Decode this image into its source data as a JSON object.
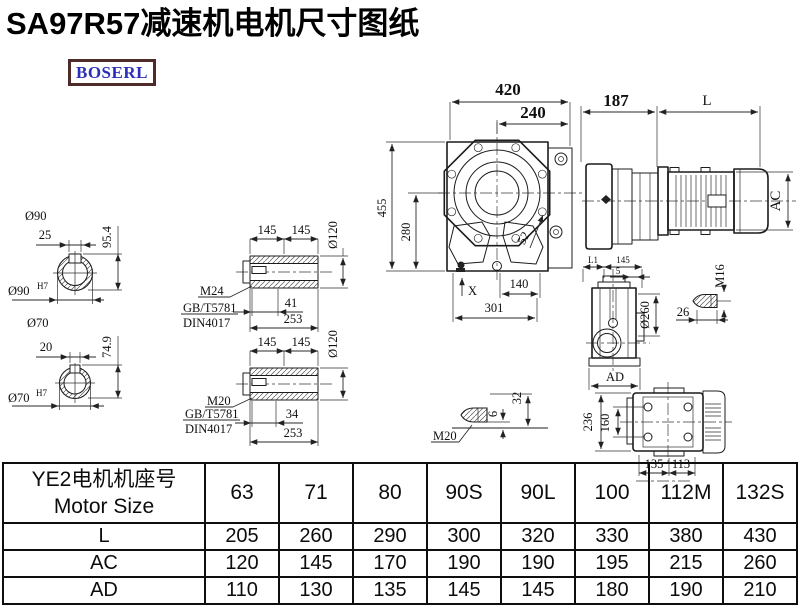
{
  "title": "SA97R57减速机电机尺寸图纸",
  "logo": "BOSERL",
  "dims": {
    "front": {
      "total_w": "420",
      "flange_w": "240",
      "total_h": "455",
      "base_h": "280",
      "bolt": "52",
      "foot_w": "140",
      "base_w": "301",
      "x_ref": "X"
    },
    "side": {
      "gearbox_len": "187",
      "motor_len": "L",
      "motor_height": "AC"
    },
    "shaft90": {
      "dia": "Ø90",
      "key_w": "25",
      "key_h": "95.4",
      "bore_dia": "Ø90",
      "bore_tol": "H7"
    },
    "shaft70": {
      "dia": "Ø70",
      "key_w": "20",
      "key_h": "74.9",
      "bore_dia": "Ø70",
      "bore_tol": "H7"
    },
    "sleeve24": {
      "half1": "145",
      "half2": "145",
      "dia": "Ø120",
      "thread": "M24",
      "std1": "GB/T5781",
      "std2": "DIN4017",
      "key_len": "41",
      "total": "253"
    },
    "sleeve20": {
      "half1": "145",
      "half2": "145",
      "dia": "Ø120",
      "thread": "M20",
      "std1": "GB/T5781",
      "std2": "DIN4017",
      "key_len": "34",
      "total": "253"
    },
    "flange": {
      "l1": "L1",
      "w": "145",
      "step": "5",
      "dia": "Ø260",
      "ad": "AD"
    },
    "bolt_m16": {
      "thread": "M16",
      "len": "26"
    },
    "bolt_m20": {
      "thread": "M20",
      "h1": "6",
      "h2": "32"
    },
    "rear": {
      "h_total": "236",
      "h_inner": "160",
      "w1": "135",
      "w2": "113"
    }
  },
  "table": {
    "header_cn": "YE2电机机座号",
    "header_en": "Motor Size",
    "columns": [
      "63",
      "71",
      "80",
      "90S",
      "90L",
      "100",
      "112M",
      "132S"
    ],
    "rows": [
      {
        "label": "L",
        "values": [
          "205",
          "260",
          "290",
          "300",
          "320",
          "330",
          "380",
          "430"
        ]
      },
      {
        "label": "AC",
        "values": [
          "120",
          "145",
          "170",
          "190",
          "190",
          "195",
          "215",
          "260"
        ]
      },
      {
        "label": "AD",
        "values": [
          "110",
          "130",
          "135",
          "145",
          "145",
          "180",
          "190",
          "210"
        ]
      }
    ]
  }
}
